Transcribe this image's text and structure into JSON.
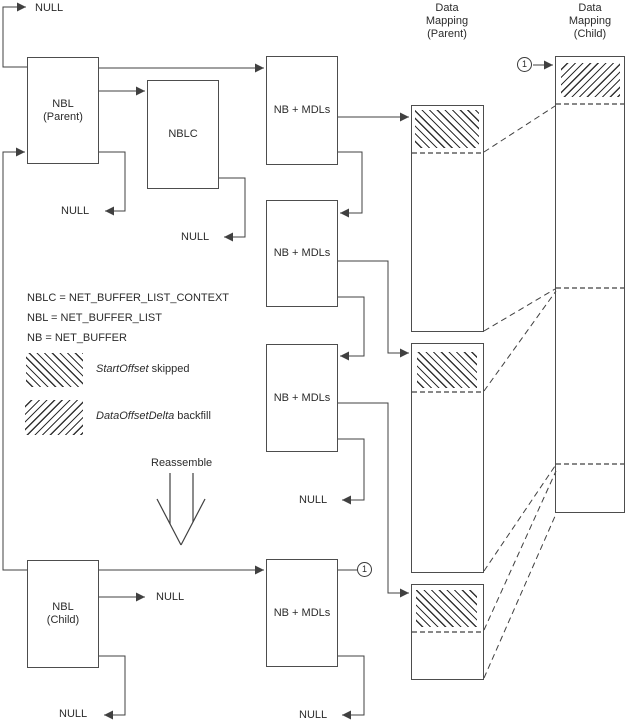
{
  "titles": {
    "parent_mapping": "Data\nMapping\n(Parent)",
    "child_mapping": "Data\nMapping\n(Child)"
  },
  "nodes": {
    "nbl_parent": "NBL\n(Parent)",
    "nblc": "NBLC",
    "nb_mdls_1": "NB + MDLs",
    "nb_mdls_2": "NB + MDLs",
    "nb_mdls_3": "NB + MDLs",
    "nb_mdls_4": "NB + MDLs",
    "nbl_child": "NBL\n(Child)"
  },
  "labels": {
    "null_value": "NULL",
    "reassemble": "Reassemble",
    "connector_badge": "1"
  },
  "legend": {
    "defs": [
      "NBLC = NET_BUFFER_LIST_CONTEXT",
      "NBL = NET_BUFFER_LIST",
      "NB = NET_BUFFER"
    ],
    "items": [
      {
        "term": "StartOffset",
        "desc": "skipped",
        "pattern": "backslash-hatch"
      },
      {
        "term": "DataOffsetDelta",
        "desc": "backfill",
        "pattern": "forwardslash-hatch"
      }
    ]
  },
  "colors": {
    "line": "#404040",
    "text": "#2b2b2b",
    "hatch": "#333333",
    "background": "#ffffff"
  }
}
